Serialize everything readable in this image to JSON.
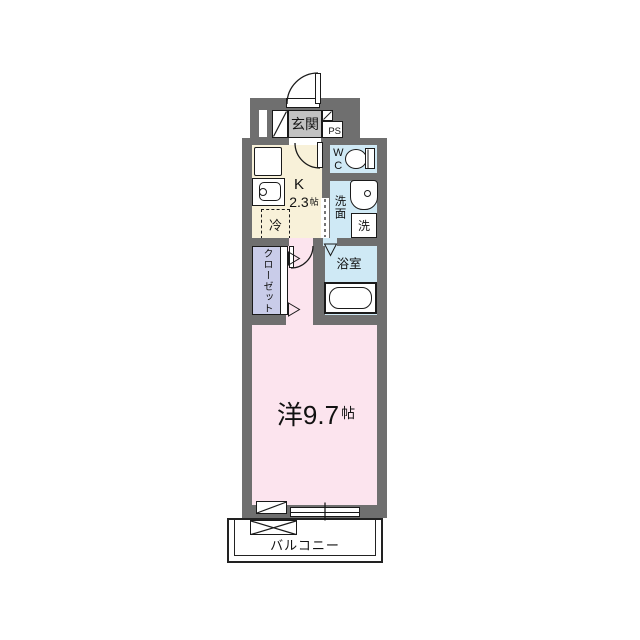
{
  "plan": {
    "entrance": {
      "label": "玄関"
    },
    "pipe_space": {
      "label": "PS"
    },
    "kitchen": {
      "label": "K",
      "size": "2.3",
      "size_unit": "帖"
    },
    "refrigerator": {
      "label": "冷"
    },
    "toilet": {
      "label": "WC"
    },
    "washroom": {
      "label": "洗面"
    },
    "washing_machine": {
      "label": "洗"
    },
    "bathroom": {
      "label": "浴室"
    },
    "closet": {
      "label": "クローゼット"
    },
    "main_room": {
      "label": "洋9.7",
      "size_unit": "帖"
    },
    "balcony": {
      "label": "バルコニー"
    }
  },
  "colors": {
    "wall": "#6f6f6f",
    "entrance_floor": "#c2c2c2",
    "kitchen_floor": "#f8f1d9",
    "wet_area_floor": "#cfe9f5",
    "closet_floor": "#c9cce9",
    "room_floor": "#fce4ee",
    "line": "#1a1a1a"
  }
}
